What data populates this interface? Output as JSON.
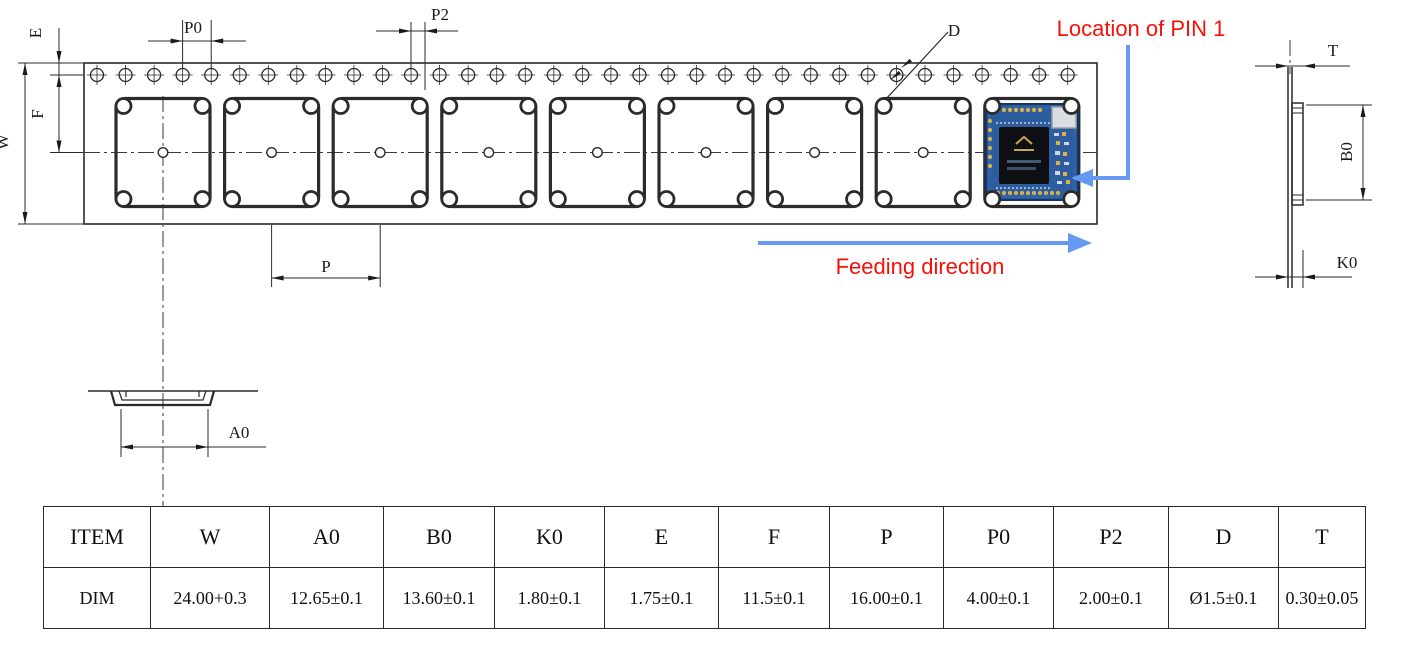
{
  "drawing": {
    "dim_labels": {
      "w": "W",
      "e": "E",
      "f": "F",
      "p0": "P0",
      "p2": "P2",
      "p": "P",
      "a0": "A0",
      "d": "D",
      "t": "T",
      "b0": "B0",
      "k0": "K0"
    },
    "annotations": {
      "pin1_location": "Location of PIN 1",
      "feeding_direction": "Feeding direction"
    },
    "colors": {
      "annotation_text_red": "#f5100a",
      "arrow_blue": "#6699f2",
      "linework": "#2a2a2a",
      "pcb_blue": "#2d5d9f"
    }
  },
  "table": {
    "header": [
      "ITEM",
      "W",
      "A0",
      "B0",
      "K0",
      "E",
      "F",
      "P",
      "P0",
      "P2",
      "D",
      "T"
    ],
    "dim": [
      "DIM",
      "24.00+0.3",
      "12.65±0.1",
      "13.60±0.1",
      "1.80±0.1",
      "1.75±0.1",
      "11.5±0.1",
      "16.00±0.1",
      "4.00±0.1",
      "2.00±0.1",
      "Ø1.5±0.1",
      "0.30±0.05"
    ]
  }
}
